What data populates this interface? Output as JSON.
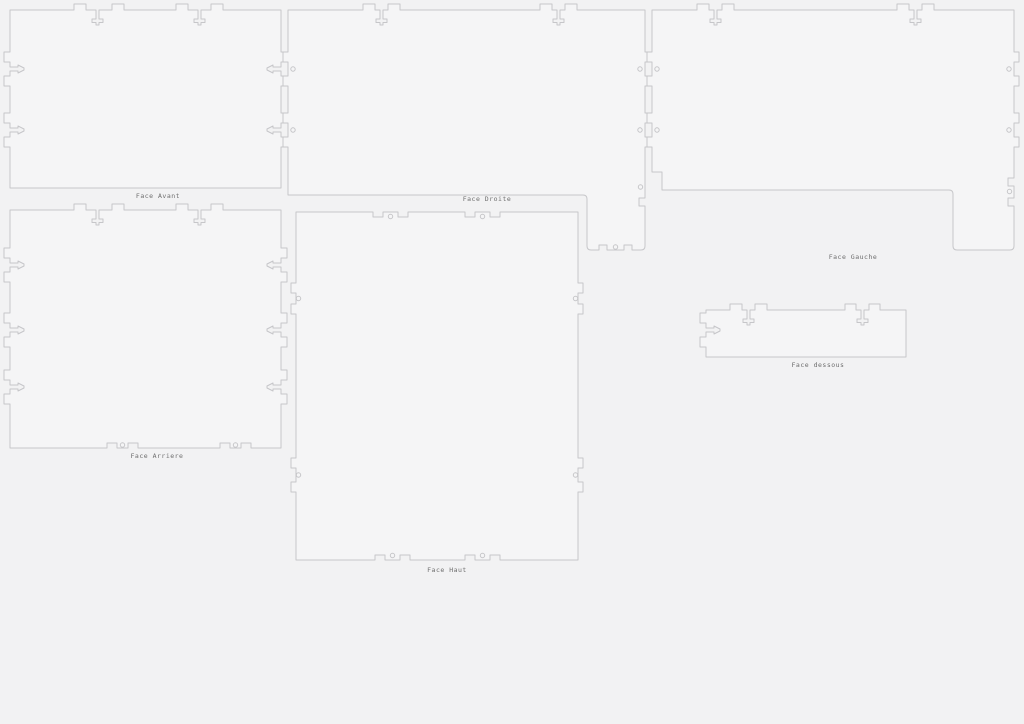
{
  "canvas": {
    "width": 1024,
    "height": 724,
    "background": "#f2f2f3",
    "stroke_color": "#c6c6c9",
    "panel_fill": "#f5f5f6",
    "label_color": "#6e6e6e",
    "label_font_size": 6.5,
    "hole_radius": 2.2
  },
  "sheet": {
    "description": "Laser-cut box panel layout with finger joints, snap clips, T-slots and screw holes",
    "panels": [
      {
        "id": "face-avant",
        "label": "Face Avant",
        "label_x": 158,
        "label_y": 198,
        "path": "M 10,10 L 74,10 L 74,4 L 86,4 L 86,10 L 96,10 L 96,19 L 92,19 L 92,22.5 L 96,22.5 L 96,25 L 99,25 L 99,22.5 L 103,22.5 L 103,19 L 99,19 L 99,10 L 112,10 L 112,4 L 124,4 L 124,10 L 176,10 L 176,4 L 188,4 L 188,10 L 198,10 L 198,19 L 194,19 L 194,22.5 L 198,22.5 L 198,25 L 201,25 L 201,22.5 L 205,22.5 L 205,19 L 201,19 L 201,10 L 211,10 L 211,4 L 223,4 L 223,10 L 281,10 L 281,52 L 287,52 L 287,62 L 281,62 L 281,67 L 273,67 L 273,65 L 267,68 L 267,70 L 273,73 L 273,71 L 281,71 L 281,76 L 287,76 L 287,86 L 281,86 L 281,113 L 287,113 L 287,123 L 281,123 L 281,128 L 273,128 L 273,126 L 267,129 L 267,131 L 273,134 L 273,132 L 281,132 L 281,137 L 287,137 L 287,147 L 281,147 L 281,188 L 10,188 L 10,147 L 4,147 L 4,137 L 10,137 L 10,132 L 18,132 L 18,134 L 24,131 L 24,129 L 18,126 L 18,128 L 10,128 L 10,123 L 4,123 L 4,113 L 10,113 L 10,86 L 4,86 L 4,76 L 10,76 L 10,71 L 18,71 L 18,73 L 24,70 L 24,68 L 18,65 L 18,67 L 10,67 L 10,62 L 4,62 L 4,52 L 10,52 Z",
        "holes": []
      },
      {
        "id": "face-droite",
        "label": "Face Droite",
        "label_x": 487,
        "label_y": 201,
        "path": "M 288,10 L 363,10 L 363,4 L 375,4 L 375,10 L 380,10 L 380,19 L 376,19 L 376,22.5 L 380,22.5 L 380,25 L 383,25 L 383,22.5 L 387,22.5 L 387,19 L 383,19 L 383,10 L 388,10 L 388,4 L 400,4 L 400,10 L 540,10 L 540,4 L 552,4 L 552,10 L 557,10 L 557,19 L 553,19 L 553,22.5 L 557,22.5 L 557,25 L 560,25 L 560,22.5 L 564,22.5 L 564,19 L 560,19 L 560,10 L 565,10 L 565,4 L 577,4 L 577,10 L 645,10 L 645,52 L 650,52 L 650,62 L 645,62 L 645,76 L 650,76 L 650,86 L 645,86 L 645,113 L 650,113 L 650,123 L 645,123 L 645,137 L 650,137 L 650,147 L 645,147 L 645,198 L 639,198 L 639,206 L 645,206 L 645,246 Q 645,250 641,250 L 632,250 L 632,245 L 624,245 L 624,250 L 607,250 L 607,245 L 599,245 L 599,250 L 591,250 Q 587,250 587,246 L 587,199 Q 587,195 583,195 L 288,195 L 288,147 L 283,147 L 283,137 L 288,137 L 288,123 L 283,123 L 283,113 L 288,113 L 288,86 L 283,86 L 283,76 L 288,76 L 288,62 L 283,62 L 283,52 L 288,52 Z",
        "holes": [
          [
            293,
            69
          ],
          [
            293,
            130
          ],
          [
            640,
            69
          ],
          [
            640,
            130
          ],
          [
            640.5,
            187
          ],
          [
            615.5,
            247
          ]
        ]
      },
      {
        "id": "face-gauche",
        "label": "Face Gauche",
        "label_x": 853,
        "label_y": 259,
        "path": "M 652,10 L 697,10 L 697,4 L 709,4 L 709,10 L 714,10 L 714,19 L 710,19 L 710,22.5 L 714,22.5 L 714,25 L 717,25 L 717,22.5 L 721,22.5 L 721,19 L 717,19 L 717,10 L 722,10 L 722,4 L 734,4 L 734,10 L 897,10 L 897,4 L 909,4 L 909,10 L 914,10 L 914,19 L 910,19 L 910,22.5 L 914,22.5 L 914,25 L 917,25 L 917,22.5 L 921,22.5 L 921,19 L 917,19 L 917,10 L 922,10 L 922,4 L 934,4 L 934,10 L 1014,10 L 1014,52 L 1019,52 L 1019,62 L 1014,62 L 1014,76 L 1019,76 L 1019,86 L 1014,86 L 1014,113 L 1019,113 L 1019,123 L 1014,123 L 1014,137 L 1019,137 L 1019,147 L 1014,147 L 1014,178 L 1008,178 L 1008,186 L 1014,186 L 1014,198 L 1008,198 L 1008,206 L 1014,206 L 1014,246 Q 1014,250 1010,250 L 957,250 Q 953,250 953,246 L 953,194 Q 953,190 949,190 L 662,190 L 662,172 L 652,172 L 652,147 L 647,147 L 647,137 L 652,137 L 652,123 L 647,123 L 647,113 L 652,113 L 652,86 L 647,86 L 647,76 L 652,76 L 652,62 L 647,62 L 647,52 L 652,52 Z",
        "holes": [
          [
            657,
            69
          ],
          [
            657,
            130
          ],
          [
            1009,
            69
          ],
          [
            1009,
            130
          ],
          [
            1009.5,
            191.5
          ]
        ]
      },
      {
        "id": "face-arriere",
        "label": "Face Arriere",
        "label_x": 157,
        "label_y": 458,
        "path": "M 10,210 L 74,210 L 74,204 L 86,204 L 86,210 L 96,210 L 96,219 L 92,219 L 92,222.5 L 96,222.5 L 96,225 L 99,225 L 99,222.5 L 103,222.5 L 103,219 L 99,219 L 99,210 L 112,210 L 112,204 L 124,204 L 124,210 L 176,210 L 176,204 L 188,204 L 188,210 L 198,210 L 198,219 L 194,219 L 194,222.5 L 198,222.5 L 198,225 L 201,225 L 201,222.5 L 205,222.5 L 205,219 L 201,219 L 201,210 L 211,210 L 211,204 L 223,204 L 223,210 L 281,210 L 281,248 L 287,248 L 287,258 L 281,258 L 281,263 L 273,263 L 273,261 L 267,264 L 267,266 L 273,269 L 273,267 L 281,267 L 281,272 L 287,272 L 287,282 L 281,282 L 281,313 L 287,313 L 287,323 L 281,323 L 281,328 L 273,328 L 273,326 L 267,329 L 267,331 L 273,334 L 273,332 L 281,332 L 281,337 L 287,337 L 287,347 L 281,347 L 281,370 L 287,370 L 287,380 L 281,380 L 281,385 L 273,385 L 273,383 L 267,386 L 267,388 L 273,391 L 273,389 L 281,389 L 281,394 L 287,394 L 287,404 L 281,404 L 281,448 L 251,448 L 251,443 L 241,443 L 241,448 L 230,448 L 230,443 L 220,443 L 220,448 L 138,448 L 138,443 L 128,443 L 128,448 L 117,448 L 117,443 L 107,443 L 107,448 L 10,448 L 10,404 L 4,404 L 4,394 L 10,394 L 10,389 L 18,389 L 18,391 L 24,388 L 24,386 L 18,383 L 18,385 L 10,385 L 10,380 L 4,380 L 4,370 L 10,370 L 10,347 L 4,347 L 4,337 L 10,337 L 10,332 L 18,332 L 18,334 L 24,331 L 24,329 L 18,326 L 18,328 L 10,328 L 10,323 L 4,323 L 4,313 L 10,313 L 10,282 L 4,282 L 4,272 L 10,272 L 10,267 L 18,267 L 18,269 L 24,266 L 24,264 L 18,261 L 18,263 L 10,263 L 10,258 L 4,258 L 4,248 L 10,248 Z",
        "holes": [
          [
            122.5,
            445
          ],
          [
            235.5,
            445
          ]
        ]
      },
      {
        "id": "face-haut",
        "label": "Face Haut",
        "label_x": 447,
        "label_y": 572,
        "path": "M 296,212 L 373,212 L 373,217 L 383,217 L 383,212 L 398,212 L 398,217 L 408,217 L 408,212 L 465,212 L 465,217 L 475,217 L 475,212 L 490,212 L 490,217 L 500,217 L 500,212 L 578,212 L 578,283 L 583,283 L 583,293 L 578,293 L 578,304 L 583,304 L 583,314 L 578,314 L 578,458 L 583,458 L 583,468 L 578,468 L 578,482 L 583,482 L 583,492 L 578,492 L 578,560 L 500,560 L 500,555 L 490,555 L 490,560 L 475,560 L 475,555 L 465,555 L 465,560 L 410,560 L 410,555 L 400,555 L 400,560 L 385,560 L 385,555 L 375,555 L 375,560 L 296,560 L 296,492 L 291,492 L 291,482 L 296,482 L 296,468 L 291,468 L 291,458 L 296,458 L 296,314 L 291,314 L 291,304 L 296,304 L 296,293 L 291,293 L 291,283 L 296,283 Z",
        "holes": [
          [
            390.5,
            216.5
          ],
          [
            482.5,
            216.5
          ],
          [
            298.5,
            298.5
          ],
          [
            575.5,
            298.5
          ],
          [
            298.5,
            475
          ],
          [
            575.5,
            475
          ],
          [
            392.5,
            555.5
          ],
          [
            482.5,
            555.5
          ]
        ]
      },
      {
        "id": "face-dessous",
        "label": "Face dessous",
        "label_x": 818,
        "label_y": 367,
        "path": "M 706,310 L 730,310 L 730,304 L 742,304 L 742,310 L 747,310 L 747,319 L 743,319 L 743,322.5 L 747,322.5 L 747,325 L 750,325 L 750,322.5 L 754,322.5 L 754,319 L 750,319 L 750,310 L 755,310 L 755,304 L 767,304 L 767,310 L 845,310 L 845,304 L 856,304 L 856,310 L 861,310 L 861,319 L 857,319 L 857,322.5 L 861,322.5 L 861,325 L 864,325 L 864,322.5 L 868,322.5 L 868,319 L 864,319 L 864,310 L 869,310 L 869,304 L 880,304 L 880,310 L 906,310 L 906,357 L 706,357 L 706,347 L 700,347 L 700,337 L 706,337 L 706,332 L 714,332 L 714,334 L 720,331 L 720,329 L 714,326 L 714,328 L 706,328 L 706,323 L 700,323 L 700,313 L 706,313 Z",
        "holes": []
      }
    ]
  }
}
